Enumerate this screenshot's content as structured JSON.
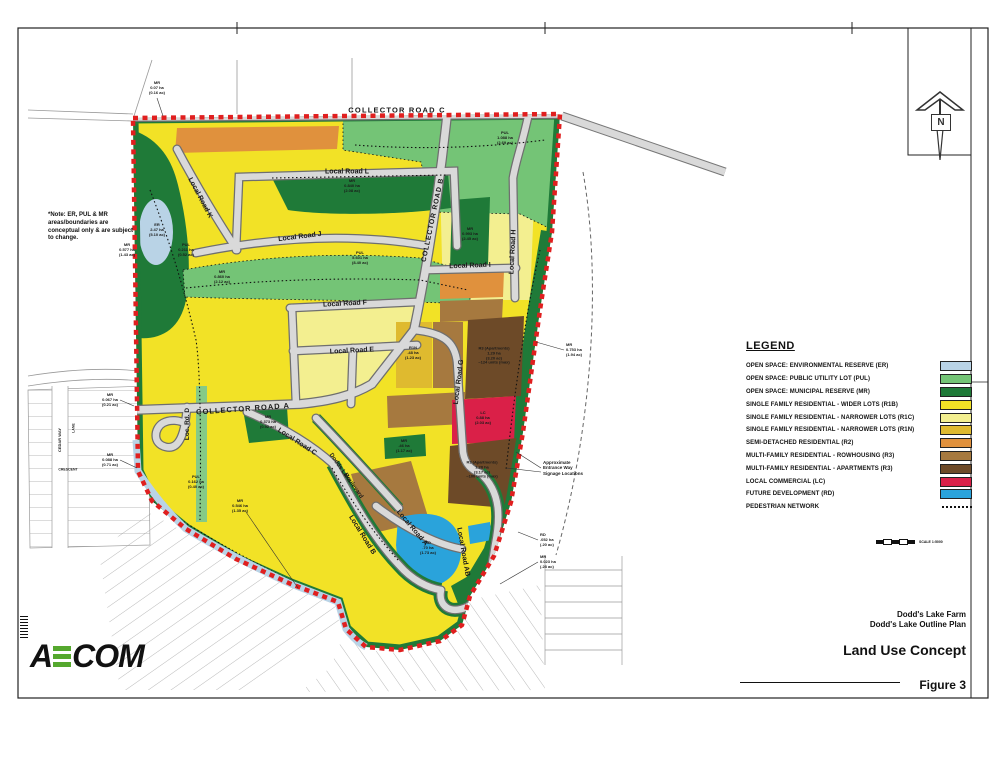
{
  "note": {
    "text": "*Note: ER, PUL & MR areas/boundaries are conceptual only & are subject to change.",
    "color": "#8a1c1c"
  },
  "north": {
    "label": "N"
  },
  "legend": {
    "heading": "LEGEND",
    "items": [
      {
        "label": "OPEN SPACE: ENVIRONMENTAL RESERVE (ER)",
        "color": "#b9d3e6",
        "type": "swatch"
      },
      {
        "label": "OPEN SPACE: PUBLIC UTILITY LOT (PUL)",
        "color": "#74c476",
        "type": "swatch"
      },
      {
        "label": "OPEN SPACE: MUNICIPAL RESERVE (MR)",
        "color": "#1f7a38",
        "type": "swatch"
      },
      {
        "label": "SINGLE FAMILY RESIDENTIAL - WIDER LOTS (R1B)",
        "color": "#f2e226",
        "type": "swatch"
      },
      {
        "label": "SINGLE FAMILY RESIDENTIAL - NARROWER LOTS (R1C)",
        "color": "#f3ef90",
        "type": "swatch"
      },
      {
        "label": "SINGLE FAMILY RESIDENTIAL - NARROWER LOTS (R1N)",
        "color": "#dfba2f",
        "type": "swatch"
      },
      {
        "label": "SEMI-DETACHED RESIDENTIAL (R2)",
        "color": "#e0913d",
        "type": "swatch"
      },
      {
        "label": "MULTI-FAMILY RESIDENTIAL - ROWHOUSING (R3)",
        "color": "#a6793f",
        "type": "swatch"
      },
      {
        "label": "MULTI-FAMILY RESIDENTIAL - APARTMENTS (R3)",
        "color": "#6d4a28",
        "type": "swatch"
      },
      {
        "label": "LOCAL COMMERCIAL (LC)",
        "color": "#da2048",
        "type": "swatch"
      },
      {
        "label": "FUTURE DEVELOPMENT (RD)",
        "color": "#2aa3db",
        "type": "swatch"
      },
      {
        "label": "PEDESTRIAN NETWORK",
        "color": "#111111",
        "type": "dotted"
      }
    ]
  },
  "scale": {
    "label": "SCALE 1:5000"
  },
  "logo": {
    "part1": "A",
    "part2": "COM",
    "full": "AECOM"
  },
  "title_block": {
    "project_line1": "Dodd's Lake Farm",
    "project_line2": "Dodd's Lake Outline Plan",
    "title": "Land Use Concept",
    "figure": "Figure 3"
  },
  "map": {
    "road_labels": [
      {
        "text": "COLLECTOR ROAD C",
        "x": 397,
        "y": 110,
        "rot": 0,
        "size": 7.5,
        "ls": 1.2
      },
      {
        "text": "COLLECTOR ROAD B",
        "x": 433,
        "y": 220,
        "rot": -78,
        "size": 7,
        "ls": 0.8
      },
      {
        "text": "COLLECTOR ROAD A",
        "x": 243,
        "y": 409,
        "rot": -4,
        "size": 7.5,
        "ls": 1
      },
      {
        "text": "Local Road L",
        "x": 347,
        "y": 172,
        "rot": 0,
        "size": 7
      },
      {
        "text": "Local Road K",
        "x": 200,
        "y": 198,
        "rot": 62,
        "size": 7
      },
      {
        "text": "Local Road J",
        "x": 300,
        "y": 237,
        "rot": -7,
        "size": 7
      },
      {
        "text": "Local Road I",
        "x": 470,
        "y": 266,
        "rot": -2,
        "size": 7
      },
      {
        "text": "Local Road H",
        "x": 513,
        "y": 252,
        "rot": -87,
        "size": 7
      },
      {
        "text": "Local Road G",
        "x": 459,
        "y": 382,
        "rot": -83,
        "size": 7
      },
      {
        "text": "Local Road F",
        "x": 345,
        "y": 304,
        "rot": -3,
        "size": 7
      },
      {
        "text": "Local Road E",
        "x": 352,
        "y": 351,
        "rot": -3,
        "size": 7
      },
      {
        "text": "Loc. Rd. D",
        "x": 188,
        "y": 424,
        "rot": -90,
        "size": 6.5
      },
      {
        "text": "Local Road C",
        "x": 297,
        "y": 442,
        "rot": 33,
        "size": 7
      },
      {
        "text": "Dodds Lake",
        "x": 340,
        "y": 468,
        "rot": 55,
        "size": 6
      },
      {
        "text": "Boulevard",
        "x": 353,
        "y": 486,
        "rot": 55,
        "size": 6
      },
      {
        "text": "Local Road B",
        "x": 362,
        "y": 535,
        "rot": 58,
        "size": 7
      },
      {
        "text": "Local Road A",
        "x": 412,
        "y": 528,
        "rot": 50,
        "size": 7
      },
      {
        "text": "Local Road AB",
        "x": 463,
        "y": 552,
        "rot": 80,
        "size": 7
      },
      {
        "text": "CEDAR WAY",
        "x": 60,
        "y": 440,
        "rot": -90,
        "size": 4
      },
      {
        "text": "LANE",
        "x": 74,
        "y": 428,
        "rot": -90,
        "size": 3.5
      },
      {
        "text": "CRESCENT",
        "x": 68,
        "y": 470,
        "rot": 0,
        "size": 3.5
      }
    ],
    "area_labels": [
      {
        "text": "MR\n0.07 ha\n(0.16 ac)",
        "x": 157,
        "y": 88,
        "size": 4
      },
      {
        "text": "ER\n2.47 ha\n(5.10 ac)",
        "x": 157,
        "y": 230,
        "size": 4
      },
      {
        "text": "MR\n0.577 ha\n(1.43 ac)",
        "x": 127,
        "y": 250,
        "size": 4
      },
      {
        "text": "PUL\n0.211 ha\n(0.52 ac)",
        "x": 186,
        "y": 250,
        "size": 4
      },
      {
        "text": "MR\n0.860 ha\n(2.12 ac)",
        "x": 222,
        "y": 277,
        "size": 4
      },
      {
        "text": "MR\n0.840 ha\n(2.08 ac)",
        "x": 352,
        "y": 186,
        "size": 4
      },
      {
        "text": "PUL\n5.601 ha\n(8.40 ac)",
        "x": 360,
        "y": 258,
        "size": 4
      },
      {
        "text": "PUL\n1.088 ha\n(2.69 ac)",
        "x": 505,
        "y": 138,
        "size": 4
      },
      {
        "text": "MR\n0.993 ha\n(2.45 ac)",
        "x": 470,
        "y": 234,
        "size": 4
      },
      {
        "text": "MR\n0.753 ha\n(1.94 ac)",
        "x": 566,
        "y": 350,
        "size": 4,
        "anchor": "left"
      },
      {
        "text": "R3 (Apartments)\n1.29 ha\n(3.20 ac)\n~124 units (max)",
        "x": 494,
        "y": 356,
        "size": 4
      },
      {
        "text": "R1N\n.48 ha\n(1.23 ac)",
        "x": 413,
        "y": 353,
        "size": 4
      },
      {
        "text": "MR\n.46 ha\n(1.17 ac)",
        "x": 404,
        "y": 446,
        "size": 4
      },
      {
        "text": "LC\n0.88 ha\n(2.03 ac)",
        "x": 483,
        "y": 418,
        "size": 4
      },
      {
        "text": "R3 (Apartments)\n1.28 ha\n(3.17 ac)\n~100 units (max)",
        "x": 482,
        "y": 470,
        "size": 4
      },
      {
        "text": "RD\n.70 ha\n(1.73 ac)",
        "x": 428,
        "y": 548,
        "size": 4
      },
      {
        "text": "PUL\n0.162 ha\n(0.40 ac)",
        "x": 196,
        "y": 482,
        "size": 4
      },
      {
        "text": "MR\n0.546 ha\n(1.35 ac)",
        "x": 240,
        "y": 506,
        "size": 4
      },
      {
        "text": "MR\n0.373 ha\n(0.92 ac)",
        "x": 268,
        "y": 422,
        "size": 4
      },
      {
        "text": "MR\n0.067 ha\n(0.21 ac)",
        "x": 110,
        "y": 400,
        "size": 4
      },
      {
        "text": "MR\n0.088 ha\n(0.71 ac)",
        "x": 110,
        "y": 460,
        "size": 4
      },
      {
        "text": "RD\n.052 ha\n(.20 ac)",
        "x": 540,
        "y": 540,
        "size": 4,
        "anchor": "left"
      },
      {
        "text": "MR\n0.023 ha\n(.28 ac)",
        "x": 540,
        "y": 562,
        "size": 4,
        "anchor": "left"
      },
      {
        "text": "Approximate\nEntrance Way\nSignage Locations",
        "x": 543,
        "y": 468,
        "size": 4.5,
        "anchor": "left"
      }
    ]
  }
}
